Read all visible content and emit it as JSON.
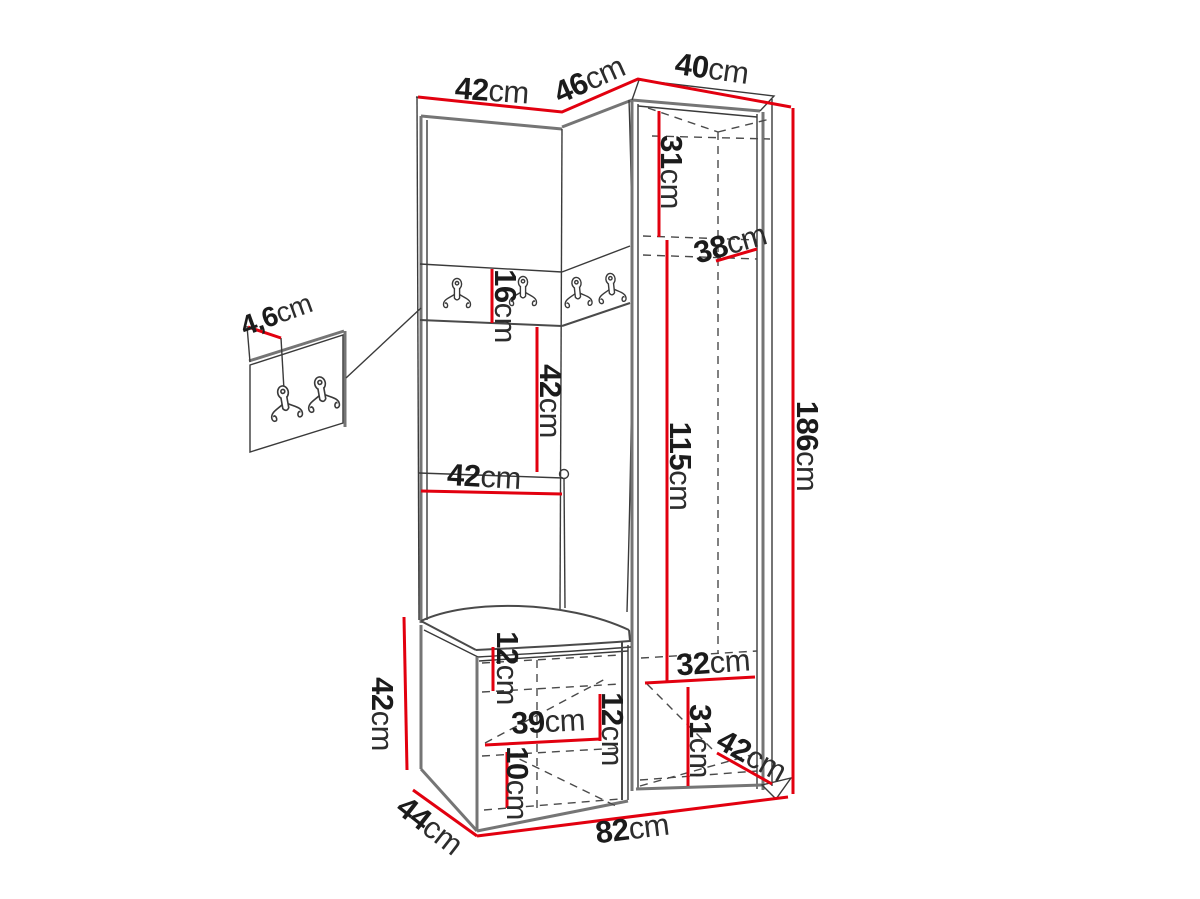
{
  "diagram": {
    "type": "furniture-dimension-drawing",
    "subject": "hallway wardrobe set with corner coat-hook panel, open shelves, bench and tall cabinet",
    "unit": "cm",
    "accent_color": "#e2000f",
    "line_color": "#3a3a3a",
    "dims": {
      "top_left_width": {
        "value": "42",
        "unit": "cm"
      },
      "top_corner_width": {
        "value": "46",
        "unit": "cm"
      },
      "top_right_width": {
        "value": "40",
        "unit": "cm"
      },
      "upper_inner_height": {
        "value": "31",
        "unit": "cm"
      },
      "upper_shelf_depth": {
        "value": "38",
        "unit": "cm"
      },
      "hook_panel_height": {
        "value": "16",
        "unit": "cm"
      },
      "middle_section_height": {
        "value": "42",
        "unit": "cm"
      },
      "shelf_width": {
        "value": "42",
        "unit": "cm"
      },
      "cabinet_inner_height": {
        "value": "115",
        "unit": "cm"
      },
      "total_height": {
        "value": "186",
        "unit": "cm"
      },
      "hook_board_thickness": {
        "value": "4,6",
        "unit": "cm"
      },
      "bench_height": {
        "value": "42",
        "unit": "cm"
      },
      "bench_upper_gap": {
        "value": "12",
        "unit": "cm"
      },
      "bench_inner_width": {
        "value": "39",
        "unit": "cm"
      },
      "bench_middle_gap": {
        "value": "12",
        "unit": "cm"
      },
      "bench_lower_gap": {
        "value": "10",
        "unit": "cm"
      },
      "shoe_shelf_width": {
        "value": "32",
        "unit": "cm"
      },
      "shoe_shelf_height": {
        "value": "31",
        "unit": "cm"
      },
      "base_depth_right": {
        "value": "42",
        "unit": "cm"
      },
      "total_width": {
        "value": "82",
        "unit": "cm"
      },
      "base_depth_left": {
        "value": "44",
        "unit": "cm"
      }
    }
  }
}
